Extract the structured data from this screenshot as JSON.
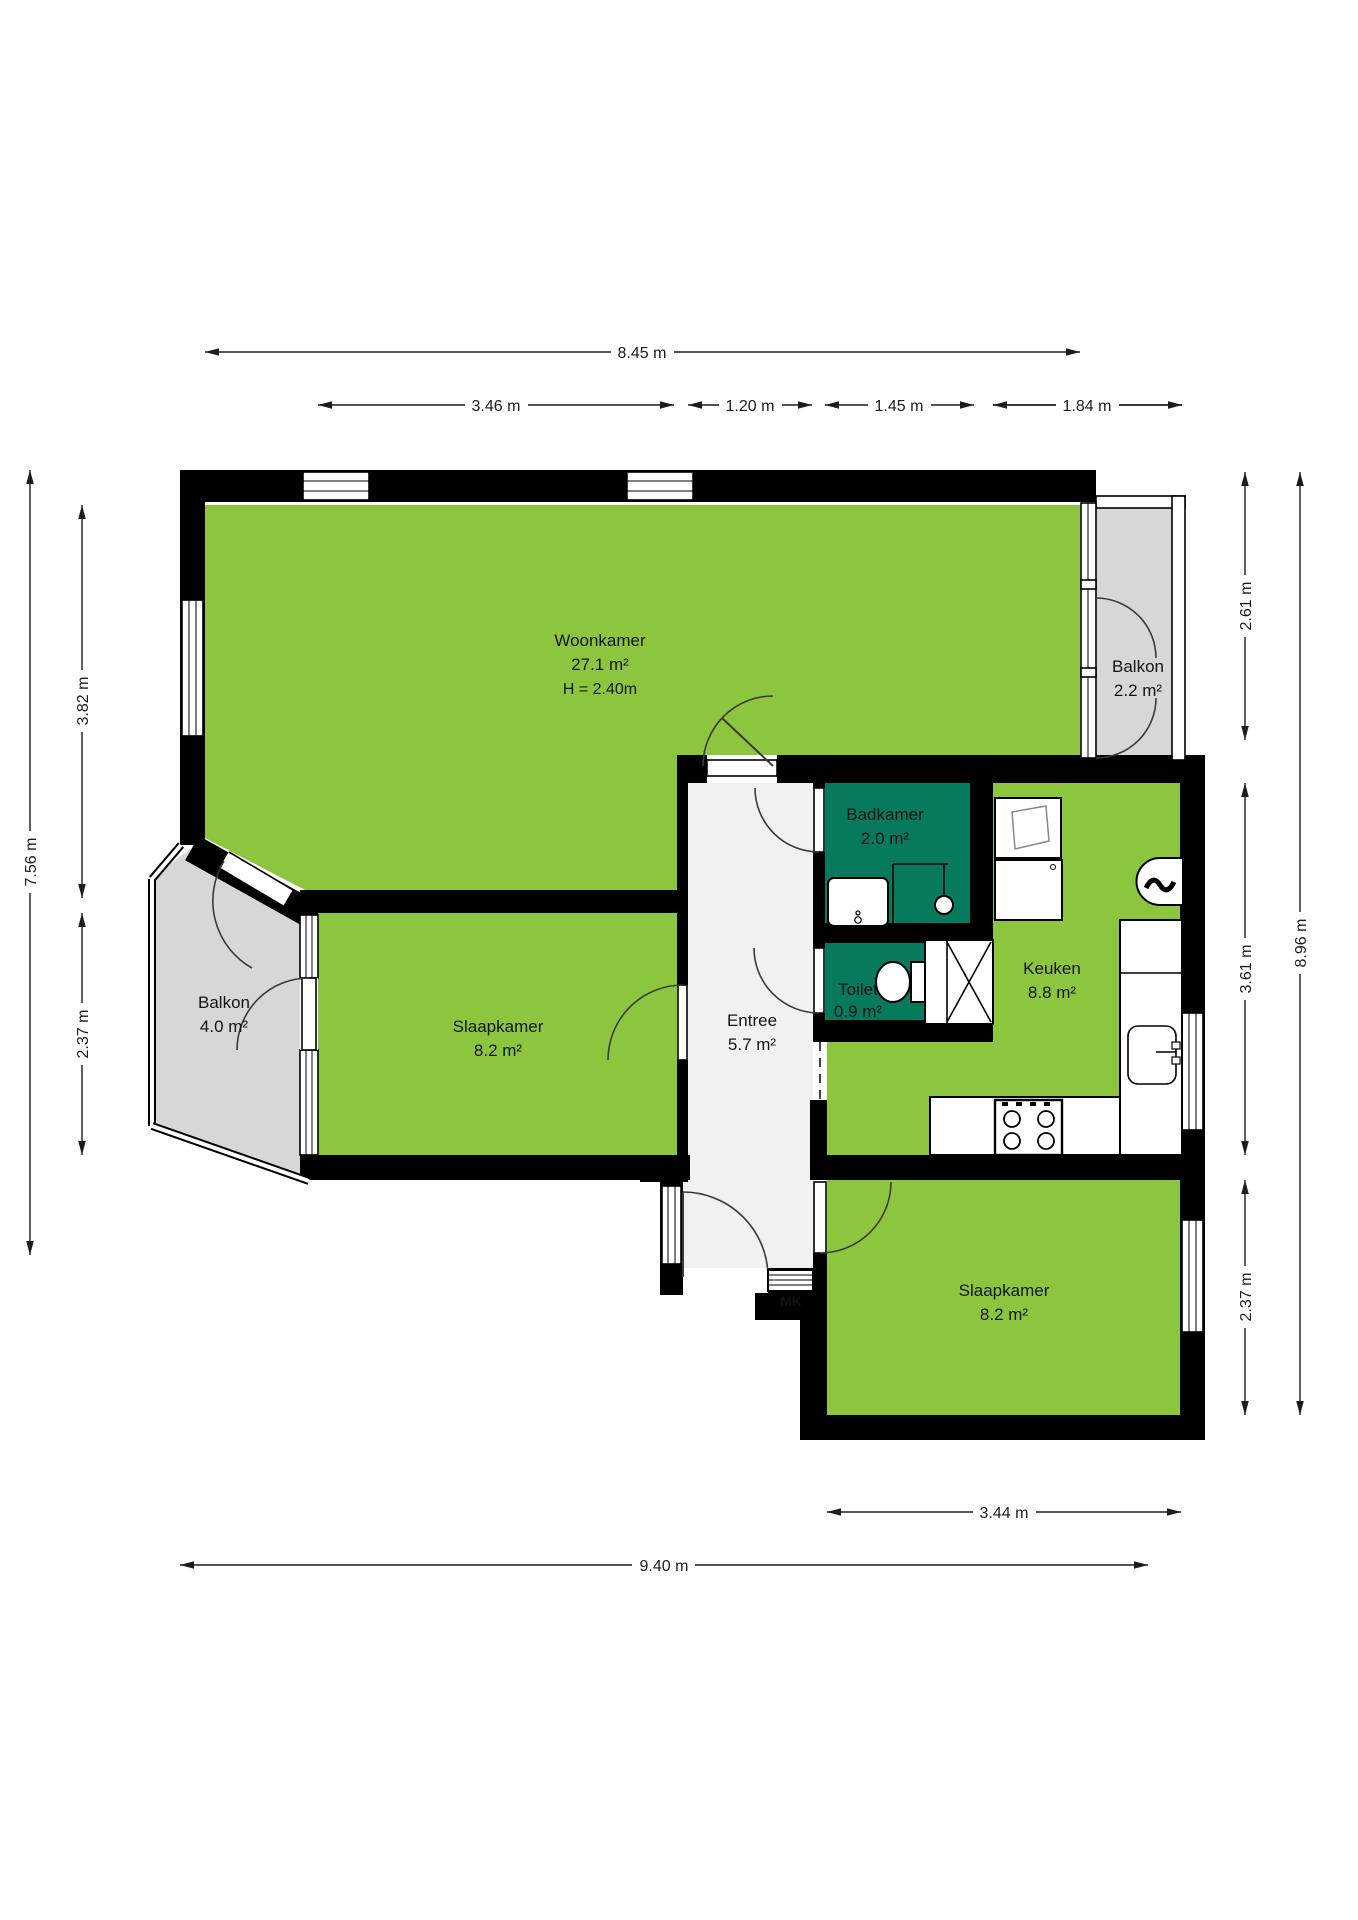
{
  "plan_type": "floor-plan",
  "colors": {
    "room_fill": "#8CC63E",
    "wet_room_fill": "#07795C",
    "balcony_fill": "#D7D7D7",
    "hall_fill": "#F1F1EF",
    "wall": "#000000",
    "dimension_text": "#1C1C1C"
  },
  "rooms": {
    "woonkamer": {
      "name": "Woonkamer",
      "area": "27.1 m²",
      "height": "H = 2.40m"
    },
    "balkon_top": {
      "name": "Balkon",
      "area": "2.2 m²"
    },
    "badkamer": {
      "name": "Badkamer",
      "area": "2.0 m²"
    },
    "toilet": {
      "name": "Toilet",
      "area": "0.9 m²"
    },
    "keuken": {
      "name": "Keuken",
      "area": "8.8 m²"
    },
    "entree": {
      "name": "Entree",
      "area": "5.7 m²"
    },
    "slaapkamer_left": {
      "name": "Slaapkamer",
      "area": "8.2 m²"
    },
    "balkon_left": {
      "name": "Balkon",
      "area": "4.0 m²"
    },
    "slaapkamer_bottom": {
      "name": "Slaapkamer",
      "area": "8.2 m²"
    }
  },
  "meter_cupboard": {
    "label": "MK"
  },
  "dimensions": {
    "top_total": "8.45 m",
    "top_segments": [
      "3.46 m",
      "1.20 m",
      "1.45 m",
      "1.84 m"
    ],
    "left_total": "7.56 m",
    "left_segments": [
      "3.82 m",
      "2.37 m"
    ],
    "right_total": "8.96 m",
    "right_segments": [
      "2.61 m",
      "3.61 m",
      "2.37 m"
    ],
    "bottom_total": "9.40 m",
    "bottom_segments": [
      "3.44 m"
    ]
  }
}
